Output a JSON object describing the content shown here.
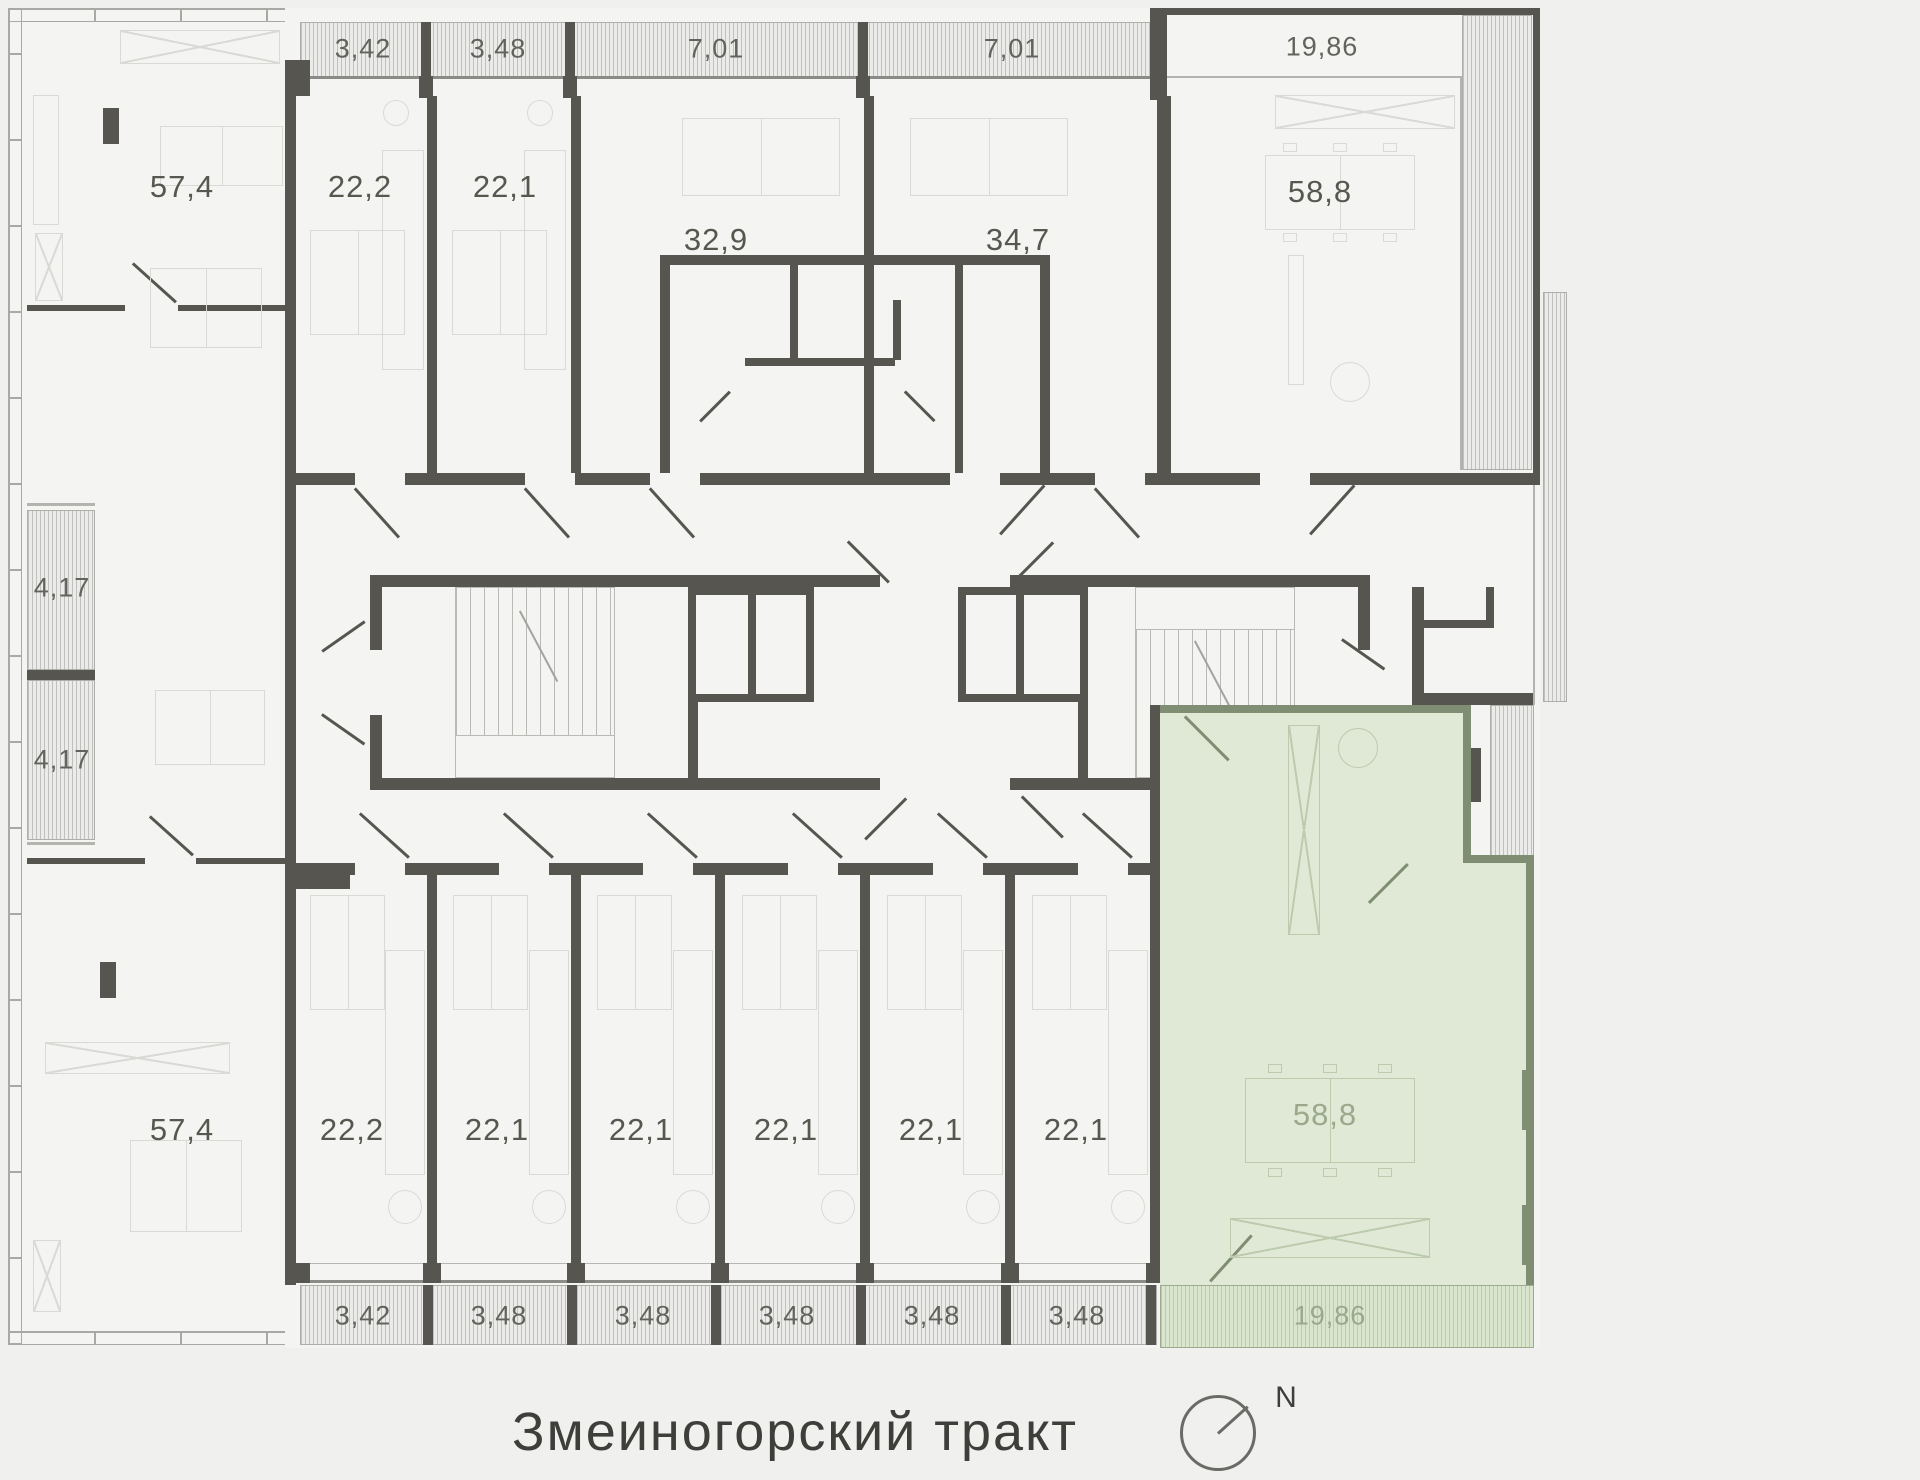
{
  "plan": {
    "street_name": "Змеиногорский тракт",
    "north_label": "N",
    "annex": {
      "top_unit_area": "57,4",
      "bottom_unit_area": "57,4",
      "side_balconies": [
        "4,17",
        "4,17"
      ]
    },
    "top_row": {
      "balconies": [
        "3,42",
        "3,48",
        "7,01",
        "7,01"
      ],
      "loggia": "19,86",
      "units": [
        "22,2",
        "22,1",
        "32,9",
        "34,7",
        "58,8"
      ]
    },
    "bottom_row": {
      "units": [
        "22,2",
        "22,1",
        "22,1",
        "22,1",
        "22,1",
        "22,1"
      ],
      "balconies": [
        "3,42",
        "3,48",
        "3,48",
        "3,48",
        "3,48",
        "3,48"
      ],
      "highlighted_unit": {
        "area": "58,8",
        "balcony_area": "19,86"
      }
    },
    "colors": {
      "wall": "#56554f",
      "highlight_fill": "#dfe9d6",
      "highlight_wall": "#7f8e72"
    }
  }
}
